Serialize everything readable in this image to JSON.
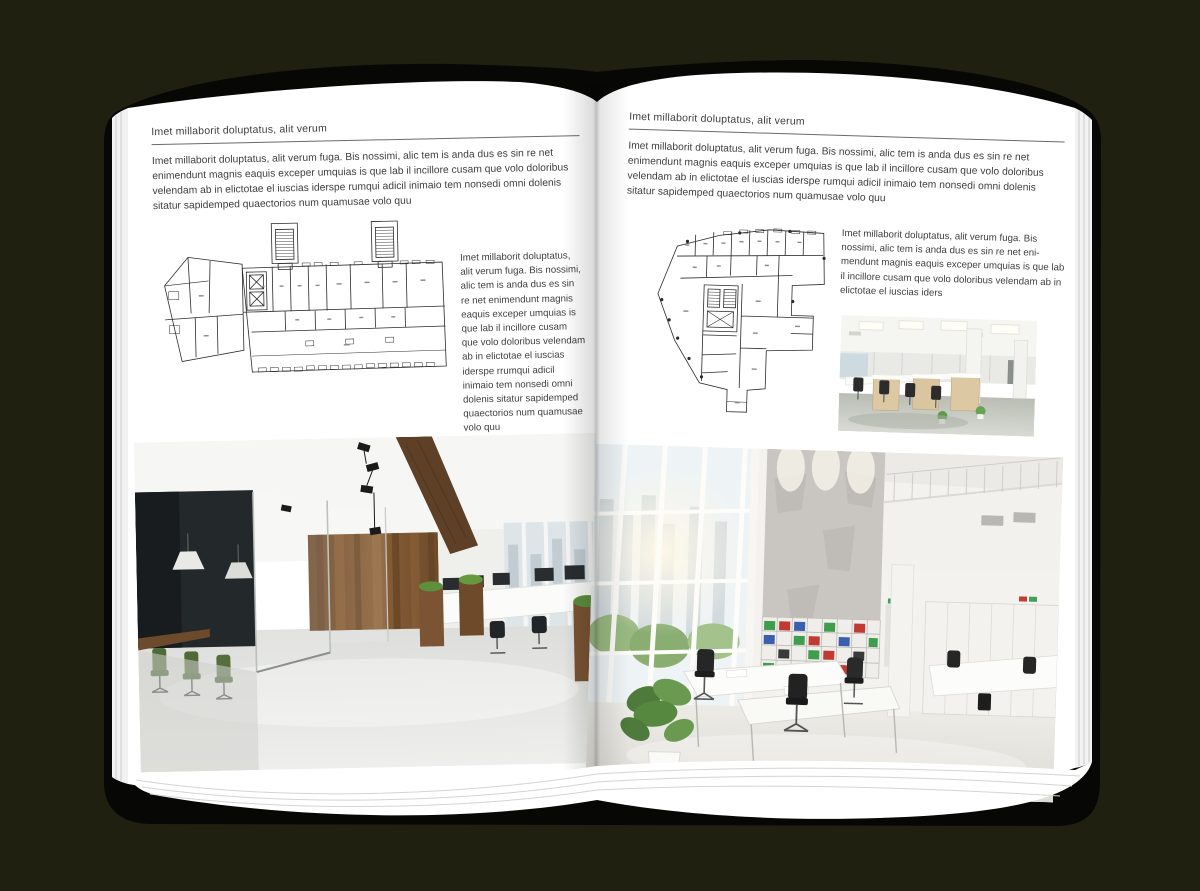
{
  "palette": {
    "background": "#1f2010",
    "cover": "#070706",
    "page": "#ffffff",
    "text": "#3d3d3d",
    "rule": "#6a6a6a"
  },
  "left_page": {
    "header": "Imet millaborit doluptatus, alit verum",
    "intro": "Imet millaborit doluptatus, alit verum fuga. Bis nossimi, alic tem is anda dus es sin re net enimendunt magnis eaquis exceper umquias is que lab il incillore cusam que volo doloribus velendam ab in elictotae el iuscias iderspe rumqui adicil inimaio tem nonsedi omni dolenis sitatur sapidemped quaectorios num quamusae volo quu",
    "caption": "Imet millaborit doluptatus, alit verum fuga. Bis nossimi, alic tem is anda dus es sin re net enimendunt magnis eaquis exceper umquias is que lab il incillore cusam que volo doloribus velendam ab in elictotae el iuscias iderspe rrumqui adicil inimaio tem nonsedi omni dolenis sitatur sapidemped quaectorios num quamusae volo quu"
  },
  "right_page": {
    "header": "Imet millaborit doluptatus, alit verum",
    "intro": "Imet millaborit doluptatus, alit verum fuga. Bis nossimi, alic tem is anda dus es sin re net enimendunt magnis eaquis exceper umquias is que lab il incillore cusam que volo doloribus velendam ab in elictotae el iuscias iderspe rumqui adicil inimaio tem nonsedi omni dolenis sitatur sapidemped quaectorios num quamusae volo quu",
    "body": "Imet millaborit doluptatus, alit verum fuga. Bis nossimi, alic tem is anda dus es sin re net eni-mendunt magnis eaquis exceper umquias is que lab il incillore cusam que volo doloribus velendam ab in elictotae el iuscias iders"
  }
}
